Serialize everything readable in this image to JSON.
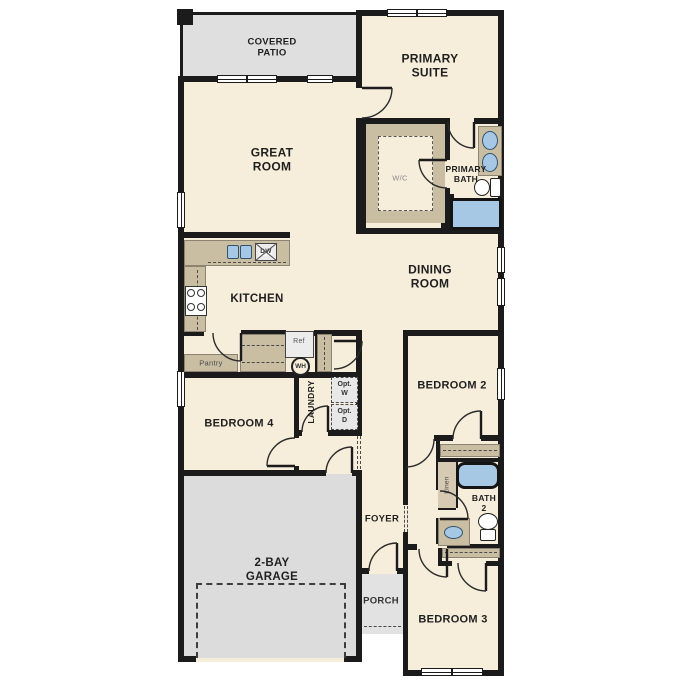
{
  "rooms": {
    "covered_patio": {
      "label": "COVERED\nPATIO"
    },
    "primary_suite": {
      "label": "PRIMARY\nSUITE"
    },
    "great_room": {
      "label": "GREAT\nROOM"
    },
    "wc": {
      "label": "W/C"
    },
    "primary_bath": {
      "label": "PRIMARY\nBATH"
    },
    "dining_room": {
      "label": "DINING\nROOM"
    },
    "kitchen": {
      "label": "KITCHEN"
    },
    "pantry": {
      "label": "Pantry"
    },
    "laundry": {
      "label": "LAUNDRY"
    },
    "bedroom2": {
      "label": "BEDROOM 2"
    },
    "bedroom3": {
      "label": "BEDROOM 3"
    },
    "bedroom4": {
      "label": "BEDROOM 4"
    },
    "foyer": {
      "label": "FOYER"
    },
    "bath2": {
      "label": "BATH\n2"
    },
    "linen": {
      "label": "Linen"
    },
    "garage": {
      "label": "2-BAY\nGARAGE"
    },
    "porch": {
      "label": "PORCH"
    }
  },
  "fixtures": {
    "refrigerator": {
      "label": "Ref"
    },
    "water_heater": {
      "label": "WH"
    },
    "dishwasher": {
      "label": "DW"
    },
    "optional_washer": {
      "label": "Opt.\nW"
    },
    "optional_dryer": {
      "label": "Opt.\nD"
    }
  },
  "colors": {
    "wall": "#1b1b1b",
    "floor": "#f6eddb",
    "patio": "#dfdfdf",
    "garage": "#dcdcdc",
    "porch": "#e2e2e2",
    "counter_tan": "#c9bda2",
    "fixture_blue": "#a7c8e5",
    "appliance_gray": "#ececec"
  }
}
